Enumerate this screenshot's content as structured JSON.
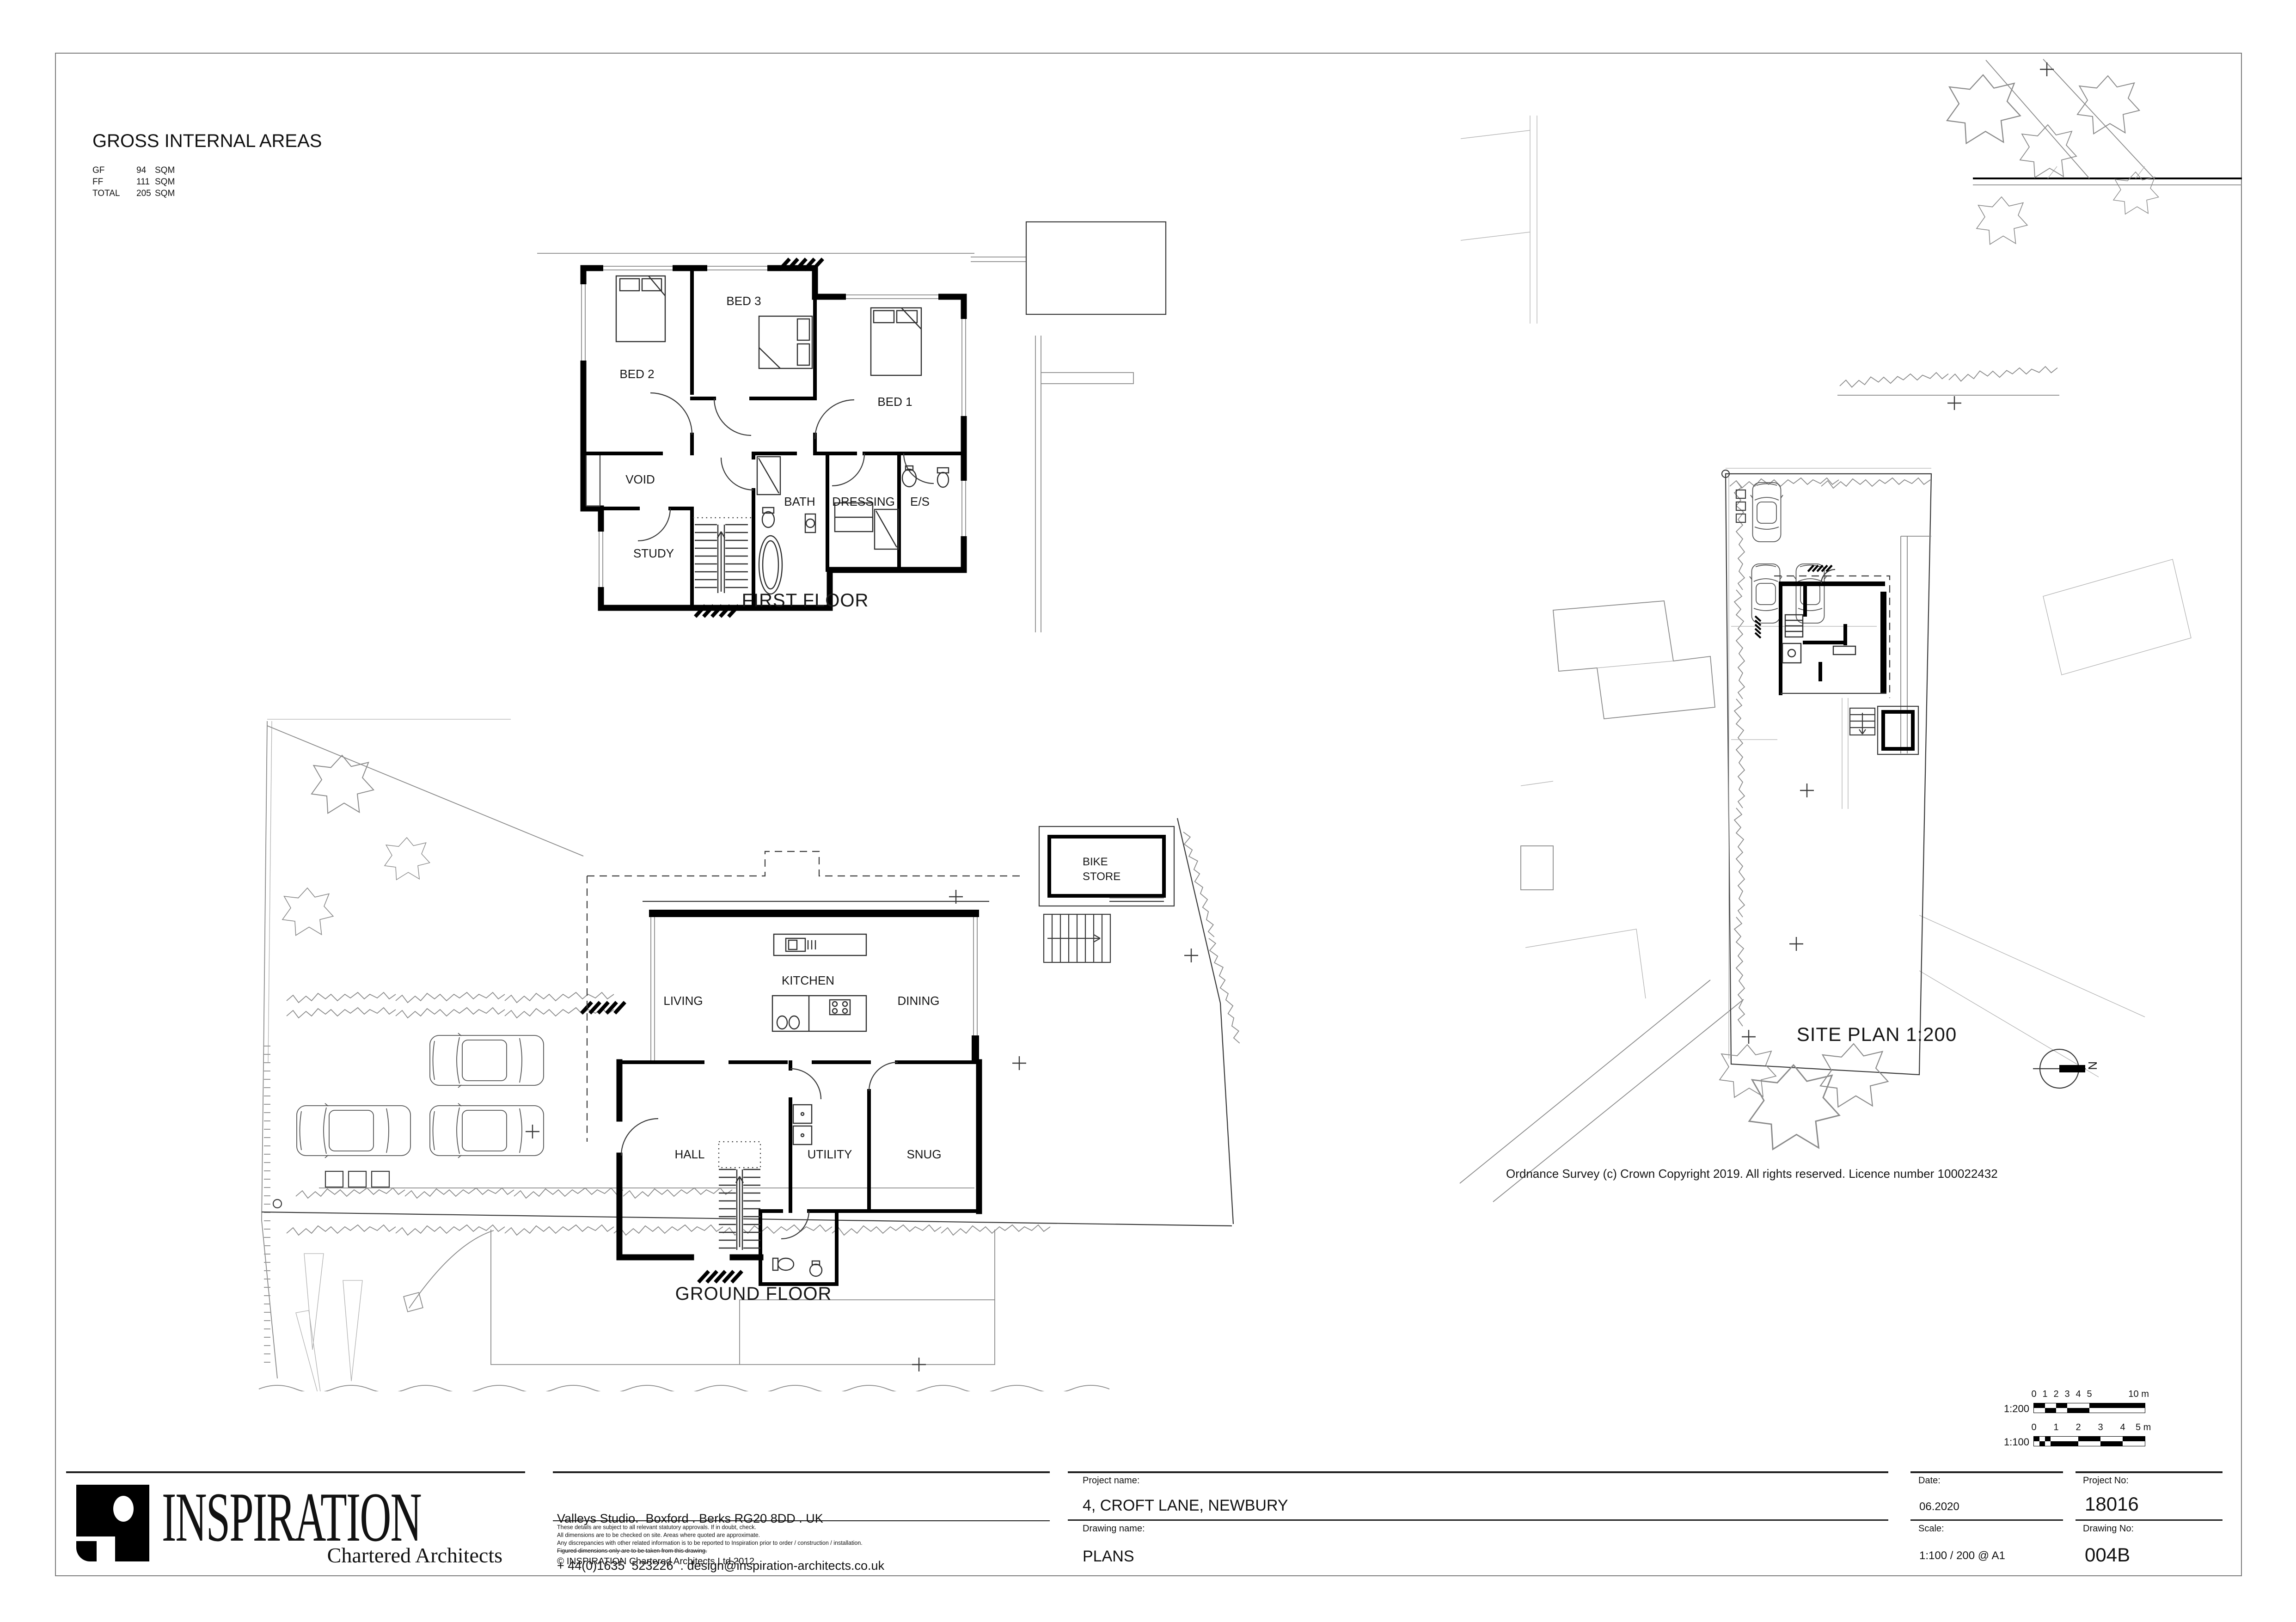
{
  "gia": {
    "title": "GROSS INTERNAL AREAS",
    "rows": [
      [
        "GF",
        "94",
        "SQM"
      ],
      [
        "FF",
        "111",
        "SQM"
      ],
      [
        "TOTAL",
        "205",
        "SQM"
      ]
    ]
  },
  "first_floor": {
    "title": "FIRST FLOOR",
    "rooms": {
      "bed2": "BED 2",
      "bed3": "BED 3",
      "bed1": "BED 1",
      "void": "VOID",
      "study": "STUDY",
      "bath": "BATH",
      "dressing": "DRESSING",
      "es": "E/S"
    }
  },
  "ground_floor": {
    "title": "GROUND FLOOR",
    "rooms": {
      "living": "LIVING",
      "kitchen": "KITCHEN",
      "dining": "DINING",
      "hall": "HALL",
      "utility": "UTILITY",
      "snug": "SNUG"
    },
    "bike_store": [
      "BIKE",
      "STORE"
    ]
  },
  "site": {
    "title": "SITE PLAN 1:200",
    "copyright": "Ordnance Survey (c) Crown Copyright 2019. All rights reserved. Licence number 100022432",
    "north_label": "N"
  },
  "scale_bars": {
    "s200": {
      "label": "1:200",
      "ticks": [
        "0",
        "1",
        "2",
        "3",
        "4",
        "5",
        "10 m"
      ]
    },
    "s100": {
      "label": "1:100",
      "ticks": [
        "0",
        "1",
        "2",
        "3",
        "4",
        "5 m"
      ]
    }
  },
  "title_block": {
    "firm": {
      "name": "INSPIRATION",
      "subtitle": "Chartered Architects"
    },
    "address_line1": "Valleys Studio.  Boxford . Berks RG20 8DD . UK",
    "address_line2": "+ 44(0)1635  523226  . design@inspiration-architects.co.uk",
    "disclaimers": [
      "These details are subject to all relevant statutory approvals. If in doubt, check.",
      "All dimensions are to be checked on site. Areas where quoted are approximate.",
      "Any discrepancies with other related information is to be reported to Inspiration prior to order / construction / installation.",
      "Figured dimensions only are to be taken from this drawing."
    ],
    "copyright": "©  INSPIRATION Chartered Architects Ltd 2012",
    "fields": {
      "project_name_label": "Project name:",
      "project_name": "4, CROFT LANE, NEWBURY",
      "drawing_name_label": "Drawing name:",
      "drawing_name": "PLANS",
      "date_label": "Date:",
      "date": "06.2020",
      "scale_label": "Scale:",
      "scale": "1:100 / 200 @ A1",
      "project_no_label": "Project No:",
      "project_no": "18016",
      "drawing_no_label": "Drawing No:",
      "drawing_no": "004B"
    }
  }
}
